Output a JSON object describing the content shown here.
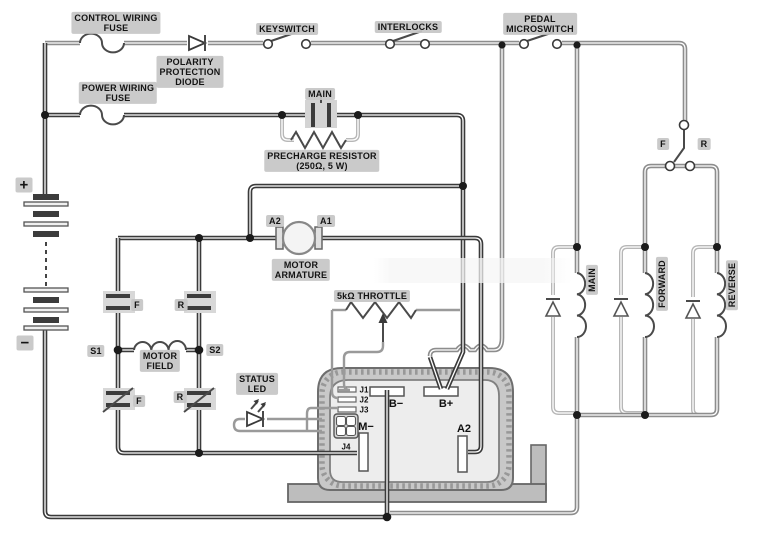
{
  "colors": {
    "wire_dark": "#3a3a3a",
    "wire_gray": "#8d8d8d",
    "wire_light": "#b7b7b7",
    "label_chip": "#c6c6c6",
    "controller_body": "#ededed",
    "controller_shell": "#c8c8c8"
  },
  "labels": {
    "control_fuse": "CONTROL WIRING\nFUSE",
    "power_fuse": "POWER WIRING\nFUSE",
    "polarity_diode": "POLARITY\nPROTECTION\nDIODE",
    "keyswitch": "KEYSWITCH",
    "interlocks": "INTERLOCKS",
    "pedal_microswitch": "PEDAL\nMICROSWITCH",
    "main_contactor": "MAIN",
    "precharge_resistor": "PRECHARGE RESISTOR\n(250Ω, 5 W)",
    "armature_a2": "A2",
    "armature_a1": "A1",
    "motor_armature": "MOTOR\nARMATURE",
    "throttle": "5kΩ THROTTLE",
    "contact_f_top": "F",
    "contact_r_top": "R",
    "contact_f_bottom": "F",
    "contact_r_bottom": "R",
    "s1": "S1",
    "s2": "S2",
    "motor_field": "MOTOR\nFIELD",
    "status_led": "STATUS\nLED",
    "selector_f": "F",
    "selector_r": "R",
    "coil_main": "MAIN",
    "coil_forward": "FORWARD",
    "coil_reverse": "REVERSE",
    "battery_plus": "+",
    "battery_minus": "−"
  },
  "controller": {
    "b_minus": "B−",
    "b_plus": "B+",
    "m_minus": "M−",
    "a2": "A2",
    "j1": "J1",
    "j2": "J2",
    "j3": "J3",
    "j4": "J4"
  }
}
